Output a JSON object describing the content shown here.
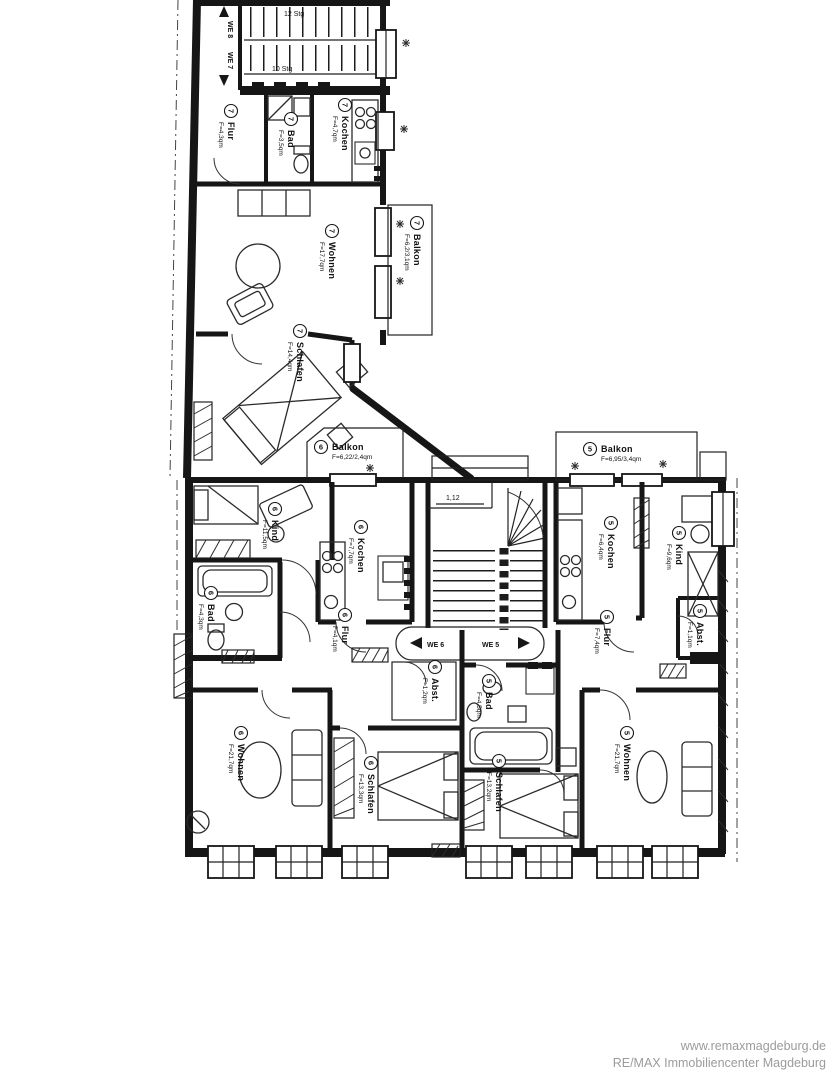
{
  "watermark": {
    "line1": "www.remaxmagdeburg.de",
    "line2": "RE/MAX Immobiliencenter Magdeburg",
    "color": "#9b9b9b"
  },
  "markers": {
    "we8": "WE 8",
    "we7": "WE 7",
    "we6": "WE 6",
    "we5": "WE 5",
    "stairs_top": "12 Stg",
    "stairs_mid": "10 Stg",
    "dim_entry": "1,12"
  },
  "rooms": [
    {
      "no": "7",
      "name": "Flur",
      "area": "F=4,3qm"
    },
    {
      "no": "7",
      "name": "Bad",
      "area": "F=3,5qm"
    },
    {
      "no": "7",
      "name": "Kochen",
      "area": "F=4,7qm"
    },
    {
      "no": "7",
      "name": "Wohnen",
      "area": "F=17,7qm"
    },
    {
      "no": "7",
      "name": "Balkon",
      "area": "F=6,2/3,1qm"
    },
    {
      "no": "7",
      "name": "Schlafen",
      "area": "F=14,4qm"
    },
    {
      "no": "6",
      "name": "Balkon",
      "area": "F=6,22/2,4qm"
    },
    {
      "no": "5",
      "name": "Balkon",
      "area": "F=6,95/3,4qm"
    },
    {
      "no": "6",
      "name": "Kind",
      "area": "F=11,5qm"
    },
    {
      "no": "6",
      "name": "Kochen",
      "area": "F=7,7qm"
    },
    {
      "no": "6",
      "name": "Bad",
      "area": "F=4,3qm"
    },
    {
      "no": "6",
      "name": "Flur",
      "area": "F=4,1qm"
    },
    {
      "no": "6",
      "name": "Abst.",
      "area": "F=1,2qm"
    },
    {
      "no": "5",
      "name": "Kochen",
      "area": "F=6,4qm"
    },
    {
      "no": "5",
      "name": "Kind",
      "area": "F=9,6qm"
    },
    {
      "no": "5",
      "name": "Flur",
      "area": "F=7,4qm"
    },
    {
      "no": "5",
      "name": "Abst.",
      "area": "F=1,1qm"
    },
    {
      "no": "5",
      "name": "Bad",
      "area": "F=4,5qm"
    },
    {
      "no": "6",
      "name": "Wohnen",
      "area": "F=21,7qm"
    },
    {
      "no": "6",
      "name": "Schlafen",
      "area": "F=13,3qm"
    },
    {
      "no": "5",
      "name": "Schlafen",
      "area": "F=13,2qm"
    },
    {
      "no": "5",
      "name": "Wohnen",
      "area": "F=21,7qm"
    }
  ]
}
